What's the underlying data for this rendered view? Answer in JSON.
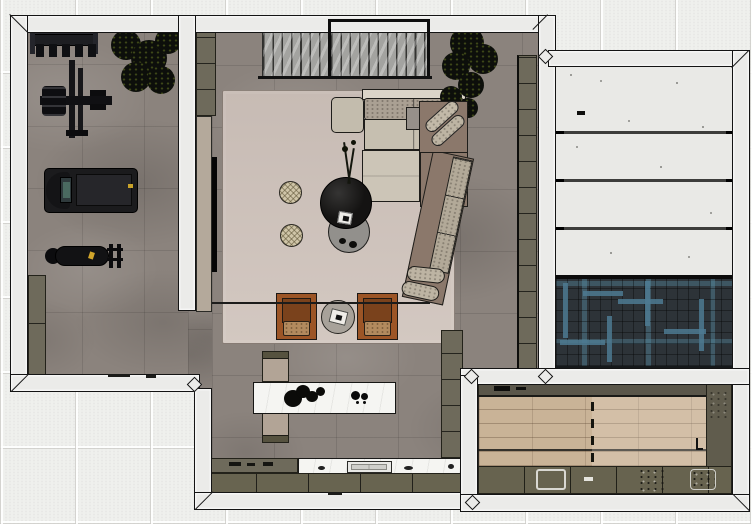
{
  "scene": {
    "title": "Top-down 3D floor plan render",
    "view": "plan view, dollhouse style, no visible text"
  },
  "palette": {
    "bg_tile": "#eff0ed",
    "wall": "#ebebe9",
    "wall_line": "#141414",
    "concrete": "#8b837d",
    "olive": "#6e6a5b",
    "olive_dark": "#57533f",
    "rug": "#ccc0b8",
    "sofa_brown": "#8b786b",
    "cushion_light": "#c6bfb0",
    "cushion_speck": "#aaa093",
    "cognac": "#9c5526",
    "cognac_dark": "#7a421c",
    "seat_tan": "#b28a5e",
    "pouf": "#cfc5a8",
    "marble": "#f5f5f2",
    "herring_base": "#2d3338",
    "herring_teal": "#4d7a92",
    "wood": "#c9b397",
    "panel_floor": "#e9e9e6",
    "black": "#111111"
  },
  "rooms": {
    "gym": {
      "label": "Home gym",
      "furniture": [
        "dumbbell rack",
        "plant",
        "cable weight machine",
        "treadmill",
        "weight bench",
        "storage cabinet"
      ]
    },
    "living": {
      "label": "Living room",
      "furniture": [
        "slatted screen",
        "media wall with TV",
        "sectional sofa",
        "lounge chair",
        "black round coffee table",
        "gray nesting table",
        "two woven poufs",
        "two cognac armchairs",
        "round side table with tray",
        "area rug",
        "floor plant"
      ]
    },
    "kitchen": {
      "label": "Kitchen",
      "furniture": [
        "marble island with cooktop",
        "two stools",
        "counter with sink",
        "olive cabinets"
      ]
    },
    "panel_room": {
      "label": "Panel room",
      "furniture": [
        "white floor panels",
        "dark herringbone floor"
      ]
    },
    "rec_room": {
      "label": "Recreation room",
      "furniture": [
        "oak lane floor with dashed line",
        "built-in olive cabinets",
        "counter sink"
      ]
    }
  }
}
